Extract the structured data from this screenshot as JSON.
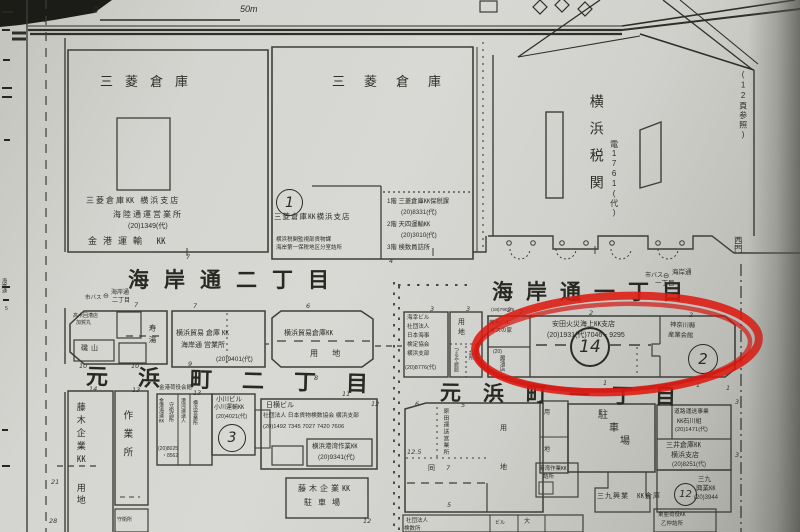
{
  "scale_bar": {
    "zero": "0",
    "end": "50m"
  },
  "streets": {
    "kaigan2": "海岸通二丁目",
    "kaigan1": "海岸通一丁目",
    "motohama2": "元浜町二丁目",
    "motohama1": "元浜町一丁目"
  },
  "bus_left": {
    "agency": "市バス",
    "icon": "⊖",
    "road": "海岸通",
    "chome": "二丁目"
  },
  "bus_right": {
    "agency": "市バス",
    "icon": "⊖",
    "road": "海岸通",
    "chome": "一丁目"
  },
  "page_ref": "(12頁参照)",
  "west_gate": "西門",
  "kaikan": "金港荷役会館",
  "margin": {
    "side": "海岸通",
    "side_n": "5"
  },
  "mitsubishi1": {
    "label": "三菱倉庫",
    "l1": "三菱倉庫㏍ 横浜支店",
    "l2": "海陸通運営業所",
    "tel": "(20)1349(代)",
    "l4": "金港運輸 ㏍"
  },
  "mitsubishi2": {
    "label": "三菱倉庫",
    "circle": "1",
    "name": "三菱倉庫㏍横浜支店",
    "sub1": "横浜税関監視部貨物課",
    "sub2": "海岸第一保税地区分室詰所",
    "annex1": "1階 三菱倉庫㏍保税課",
    "annex1_tel": "(20)8331(代)",
    "annex2": "2階 天四運輸㏍",
    "annex2_tel": "(20)3010(代)",
    "annex3": "3階 検数員詰所"
  },
  "customs": {
    "name": "横浜税関",
    "tel": "電1761(代)"
  },
  "boeki": {
    "l1": "横浜貿易 倉庫 ㏍",
    "l2": "海岸通 営業所",
    "tel": "(20)9401(代)"
  },
  "isoyama": {
    "note1": "高木回漕店",
    "note2": "加賀丸",
    "name": "磯山",
    "bath": "寿湯"
  },
  "yochi1": {
    "l1": "横浜貿易倉庫㏍",
    "l2": "用 地"
  },
  "kaiko": {
    "l1": "海幸ビル",
    "l2": "社団法人",
    "l3": "日本海事",
    "l4": "検定協会",
    "l5": "横浜支部",
    "tel": "(20)8776(代)"
  },
  "yochi2": {
    "label": "用地",
    "v1": "つるや旅館",
    "v2": "詰所"
  },
  "b14": {
    "circle": "14",
    "l1": "安田火災海上㏍支店",
    "tel": "(20)1931(代)7046・9295",
    "cell1a": "横浜ビル",
    "cell1b": "マスの家",
    "cell2a": "(20)",
    "cell2b": "醤油店",
    "lot": "(18)7901/5"
  },
  "b2": {
    "circle": "2",
    "l1": "神奈川縣",
    "l2": "産業会館"
  },
  "fujiki": {
    "name": "藤木企業㏍",
    "yochi": "用地"
  },
  "sagyo": {
    "name": "作業所",
    "sub": "守衛所"
  },
  "cluster": {
    "v1": "金港海運㏍",
    "v2": "守衛詰所",
    "v3": "港湾運送人",
    "v4": "横浜営業所",
    "tel1": "(20)8025",
    "tel2": "・8562"
  },
  "ogawa": {
    "circle": "3",
    "l1": "小川ビル",
    "l2": "小川運輸㏍",
    "tel": "(20)4021(代)"
  },
  "kensu": {
    "l1": "日横ビル",
    "l2": "社団法人 日本貨物検数協会 横浜支部",
    "tel": "(20)1492 7345 7027 7420 7606"
  },
  "kowan": {
    "l1": "横浜港湾作業㏍",
    "tel": "(20)9341(代)"
  },
  "fpark": {
    "l1": "藤木企業㏍",
    "l2": "駐車場"
  },
  "harada": {
    "v": "原田運送営業所",
    "do": "同",
    "yo": "用",
    "chi": "地"
  },
  "cell540": {
    "yo": "用",
    "chi": "地"
  },
  "parkR": {
    "c1": "駐",
    "c2": "車",
    "c3": "場"
  },
  "sanku_soko": "三九興業　㏍倉庫",
  "ishikawa": {
    "l1": "道路運送事業",
    "l2": "㏍石川組",
    "tel": "(20)1471(代)"
  },
  "mitsui": {
    "l1": "三井倉庫㏍",
    "l2": "横浜支店",
    "tel": "(20)8251(代)"
  },
  "sanku": {
    "circle": "12",
    "l1": "三九",
    "l2": "興業㏍",
    "tel": "(20)3944"
  },
  "toa": {
    "l1": "東亜荷役㏍",
    "l2": "乙仲詰所"
  },
  "t540": {
    "l1": "港湾作業㏍",
    "l2": "詰所"
  },
  "btmctr": {
    "l1": "社団法人",
    "l2": "検数所",
    "c1": "ビル",
    "c2": "大"
  },
  "colors": {
    "red_annotation": "#dd1a10",
    "ink": "#3a3a34",
    "paper": "#d4d4d0"
  },
  "dims": [
    {
      "v": "7",
      "x": 134,
      "y": 301
    },
    {
      "v": "7",
      "x": 193,
      "y": 302
    },
    {
      "v": "6",
      "x": 306,
      "y": 302
    },
    {
      "v": "3",
      "x": 430,
      "y": 305
    },
    {
      "v": "3",
      "x": 466,
      "y": 305
    },
    {
      "v": "2",
      "x": 507,
      "y": 306
    },
    {
      "v": "2",
      "x": 589,
      "y": 309
    },
    {
      "v": "2",
      "x": 689,
      "y": 311
    },
    {
      "v": "2",
      "x": 519,
      "y": 308
    },
    {
      "v": "7",
      "x": 186,
      "y": 253
    },
    {
      "v": "4",
      "x": 389,
      "y": 257
    },
    {
      "v": "10",
      "x": 79,
      "y": 362
    },
    {
      "v": "10",
      "x": 131,
      "y": 362
    },
    {
      "v": "9",
      "x": 188,
      "y": 360
    },
    {
      "v": "8",
      "x": 314,
      "y": 374
    },
    {
      "v": "14",
      "x": 89,
      "y": 385
    },
    {
      "v": "13",
      "x": 132,
      "y": 386
    },
    {
      "v": "13",
      "x": 193,
      "y": 389
    },
    {
      "v": "11",
      "x": 342,
      "y": 390
    },
    {
      "v": "12",
      "x": 371,
      "y": 400
    },
    {
      "v": "12",
      "x": 363,
      "y": 517
    },
    {
      "v": "6",
      "x": 415,
      "y": 400
    },
    {
      "v": "5",
      "x": 461,
      "y": 401
    },
    {
      "v": "12.5",
      "x": 407,
      "y": 448
    },
    {
      "v": "7",
      "x": 446,
      "y": 464
    },
    {
      "v": "5",
      "x": 447,
      "y": 501
    },
    {
      "v": "3",
      "x": 735,
      "y": 398
    },
    {
      "v": "3",
      "x": 735,
      "y": 451
    },
    {
      "v": "1",
      "x": 603,
      "y": 379
    },
    {
      "v": "1",
      "x": 696,
      "y": 381
    },
    {
      "v": "1",
      "x": 726,
      "y": 384
    },
    {
      "v": "21",
      "x": 51,
      "y": 478
    },
    {
      "v": "28",
      "x": 49,
      "y": 517
    }
  ]
}
